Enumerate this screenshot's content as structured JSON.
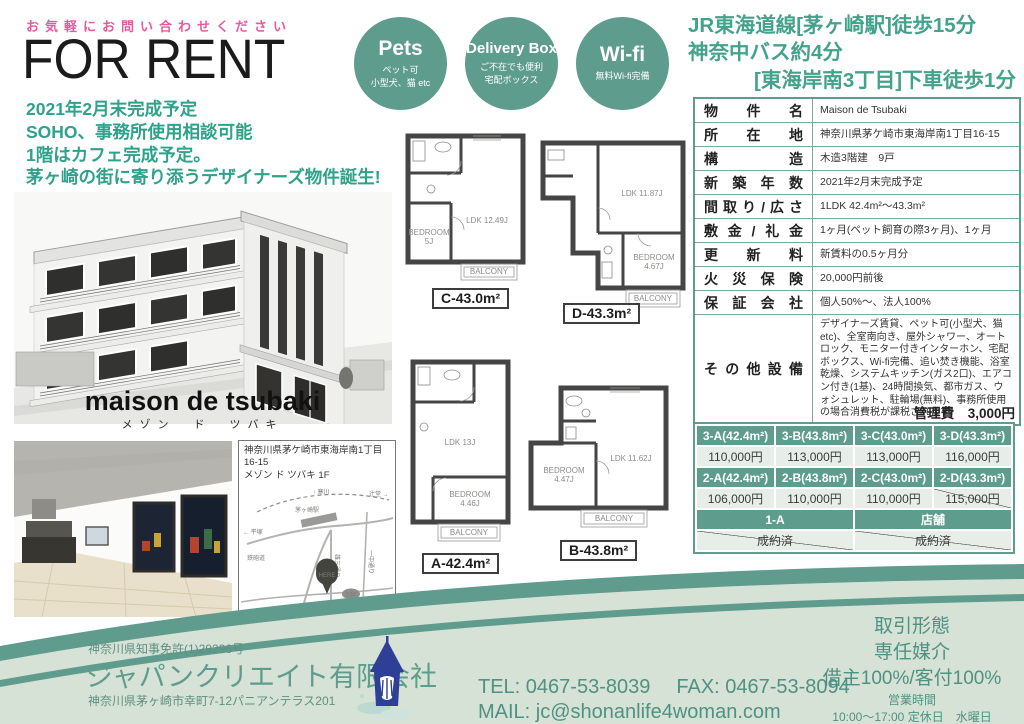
{
  "colors": {
    "teal": "#5e9d8e",
    "teal_text": "#43a28b",
    "pink": "#e75a9e",
    "footer_bg": "#d6e2d5",
    "cell_bg": "#e7eee8"
  },
  "header": {
    "contact": "お気軽にお問い合わせください",
    "title": "FOR RENT",
    "highlights": [
      "2021年2月末完成予定",
      "SOHO、事務所使用相談可能",
      "1階はカフェ完成予定。",
      "茅ヶ崎の街に寄り添うデザイナーズ物件誕生!"
    ]
  },
  "access": [
    "JR東海道線[茅ヶ崎駅]徒歩15分",
    "神奈中バス約4分",
    "[東海岸南3丁目]下車徒歩1分"
  ],
  "badges": [
    {
      "title": "Pets",
      "line1": "ペット可",
      "line2": "小型犬、猫 etc"
    },
    {
      "title": "Delivery Box",
      "line1": "ご不在でも便利",
      "line2": "宅配ボックス"
    },
    {
      "title": "Wi-fi",
      "line1": "無料Wi-fi完備",
      "line2": ""
    }
  ],
  "building": {
    "name": "maison de tsubaki",
    "kana": "メゾン　ド　ツバキ"
  },
  "property_table": {
    "rows": [
      {
        "label": "物件名",
        "value": "Maison de Tsubaki"
      },
      {
        "label": "所在地",
        "value": "神奈川県茅ケ崎市東海岸南1丁目16-15"
      },
      {
        "label": "構造",
        "value": "木造3階建　9戸"
      },
      {
        "label": "新築年数",
        "value": "2021年2月末完成予定"
      },
      {
        "label": "間取り/広さ",
        "value": "1LDK 42.4m²〜43.3m²"
      },
      {
        "label": "敷金/礼金",
        "value": "1ヶ月(ペット飼育の際3ヶ月)、1ヶ月"
      },
      {
        "label": "更新料",
        "value": "新賃料の0.5ヶ月分"
      },
      {
        "label": "火災保険",
        "value": "20,000円前後"
      },
      {
        "label": "保証会社",
        "value": "個人50%〜、法人100%"
      },
      {
        "label": "その他設備",
        "value": "デザイナーズ賃貸、ペット可(小型犬、猫 etc)、全室南向き、屋外シャワー、オートロック、モニター付きインターホン、宅配ボックス、Wi-fi完備、追い焚き機能、浴室乾燥、システムキッチン(ガス2口)、エアコン付き(1基)、24時間換気、都市ガス、ウォシュレット、駐輪場(無料)、事務所使用の場合消費税が課税されます。"
      }
    ]
  },
  "management_fee": "管理費　3,000円",
  "price_table": {
    "groups": [
      {
        "headers": [
          "3-A(42.4m²)",
          "3-B(43.8m²)",
          "3-C(43.0m²)",
          "3-D(43.3m²)"
        ],
        "values": [
          "110,000円",
          "113,000円",
          "113,000円",
          "116,000円"
        ],
        "sold": [
          false,
          false,
          false,
          false
        ]
      },
      {
        "headers": [
          "2-A(42.4m²)",
          "2-B(43.8m²)",
          "2-C(43.0m²)",
          "2-D(43.3m²)"
        ],
        "values": [
          "106,000円",
          "110,000円",
          "110,000円",
          "115,000円"
        ],
        "sold": [
          false,
          false,
          false,
          true
        ]
      }
    ],
    "bottom": {
      "headers": [
        "1-A",
        "店舗"
      ],
      "values": [
        "成約済",
        "成約済"
      ],
      "sold": [
        true,
        true
      ]
    }
  },
  "floorplans": [
    {
      "caption": "C-43.0m²",
      "ldk": "LDK 12.49J",
      "bedroom": "BEDROOM",
      "bedroom_size": "5J",
      "balcony": "BALCONY"
    },
    {
      "caption": "D-43.3m²",
      "ldk": "LDK 11.87J",
      "bedroom": "BEDROOM",
      "bedroom_size": "4.67J",
      "balcony": "BALCONY"
    },
    {
      "caption": "A-42.4m²",
      "ldk": "LDK 13J",
      "bedroom": "BEDROOM",
      "bedroom_size": "4.46J",
      "balcony": "BALCONY"
    },
    {
      "caption": "B-43.8m²",
      "ldk": "LDK 11.62J",
      "bedroom": "BEDROOM",
      "bedroom_size": "4.47J",
      "balcony": "BALCONY"
    }
  ],
  "map_panel": {
    "address_line1": "神奈川県茅ケ崎市東海岸南1丁目16-15",
    "address_line2": "メゾン ド ツバキ 1F",
    "labels": {
      "north": "↑ 寒川",
      "right": "辻堂 →",
      "left": "← 平塚",
      "station": "茅ヶ崎駅",
      "road_v1": "雄三通り",
      "road_v2": "一中通り",
      "road_h": "鉄砲道",
      "route": "134",
      "here": "HERE",
      "coast": "サザンビーチちがさき海水浴場"
    }
  },
  "footer": {
    "license": "神奈川県知事免許(1)29296号",
    "company": "ジャパンクリエイト有限会社",
    "address": "神奈川県茅ヶ崎市幸町7-12パニアンテラス201",
    "tel": "TEL: 0467-53-8039",
    "fax": "FAX: 0467-53-8094",
    "mail": "MAIL: jc@shonanlife4woman.com",
    "deal_type_label": "取引形態",
    "deal_type": "専任媒介",
    "commission": "借主100%/客付100%",
    "hours_label": "営業時間",
    "hours": "10:00〜17:00 定休日　水曜日"
  }
}
